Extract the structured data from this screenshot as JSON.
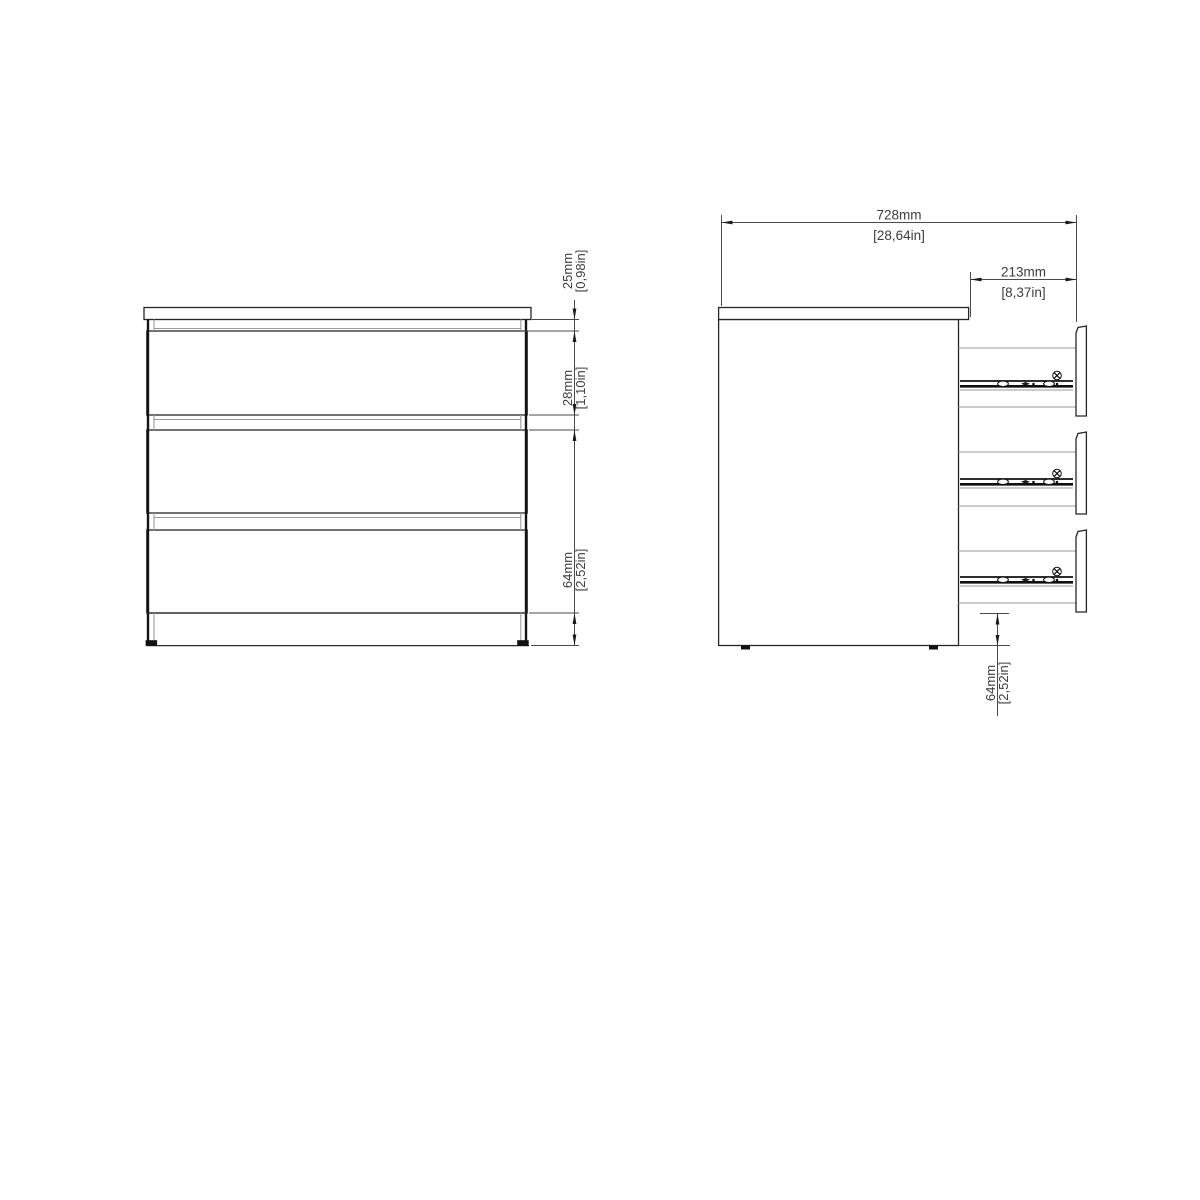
{
  "colors": {
    "background": "#ffffff",
    "outline": "#262626",
    "light_line": "#9a9a9a",
    "dimension_line": "#4a4a4a",
    "text": "#3d3d3d"
  },
  "front_view": {
    "dimensions": {
      "top_gap": {
        "metric": "25mm",
        "imperial": "[0,98in]"
      },
      "drawer_gap": {
        "metric": "28mm",
        "imperial": "[1,10in]"
      },
      "base_height": {
        "metric": "64mm",
        "imperial": "[2,52in]"
      }
    }
  },
  "side_view": {
    "dimensions": {
      "total_depth": {
        "metric": "728mm",
        "imperial": "[28,64in]"
      },
      "drawer_extension": {
        "metric": "213mm",
        "imperial": "[8,37in]"
      },
      "base_height": {
        "metric": "64mm",
        "imperial": "[2,52in]"
      }
    }
  }
}
